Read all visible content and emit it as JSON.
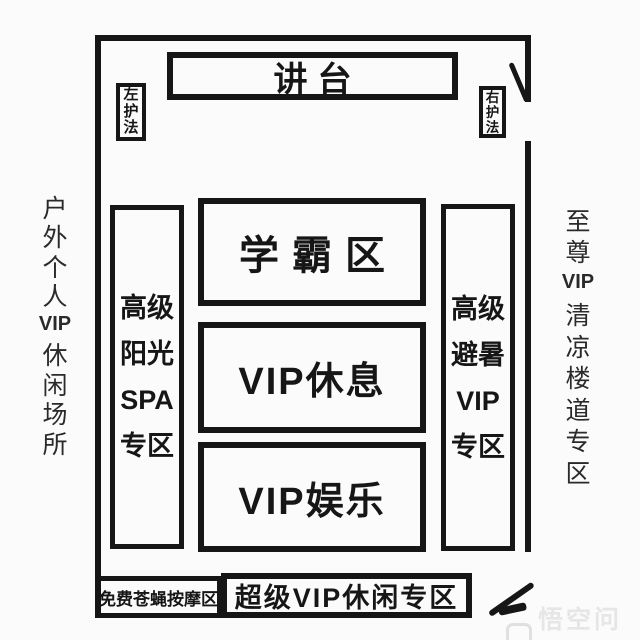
{
  "colors": {
    "ink": "#161616",
    "paper": "#fbfbfb",
    "watermark": "#e6e6e6"
  },
  "podium": {
    "label": "讲台"
  },
  "guards": {
    "left": {
      "chars": [
        "左",
        "护",
        "法"
      ]
    },
    "right": {
      "chars": [
        "右",
        "护",
        "法"
      ]
    }
  },
  "outside": {
    "left": {
      "segments": [
        "户",
        "外",
        "个",
        "人",
        "VIP",
        "休",
        "闲",
        "场",
        "所"
      ]
    },
    "right": {
      "segments": [
        "至",
        "尊",
        "VIP",
        "清",
        "凉",
        "楼",
        "道",
        "专",
        "区"
      ]
    }
  },
  "zones": {
    "sunshine_spa": {
      "lines": [
        "高级",
        "阳光",
        "SPA",
        "专区"
      ]
    },
    "summer_escape": {
      "lines": [
        "高级",
        "避暑",
        "VIP",
        "专区"
      ]
    },
    "top_students": {
      "label": "学霸区"
    },
    "vip_rest": {
      "label": "VIP休息"
    },
    "vip_fun": {
      "label": "VIP娱乐"
    },
    "fly_massage": {
      "label": "免费苍蝇按摩区"
    },
    "super_vip": {
      "label": "超级VIP休闲专区"
    }
  },
  "watermark": {
    "text": "悟空问答"
  }
}
